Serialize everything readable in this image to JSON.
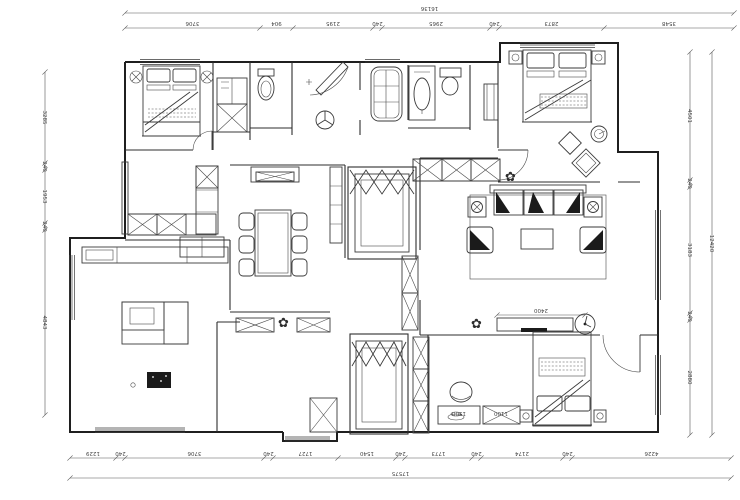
{
  "drawing": {
    "type": "residential-floor-plan",
    "units": "mm",
    "colors": {
      "line": "#1f1f1f",
      "background": "#ffffff",
      "dim_text": "#444444"
    }
  },
  "dimensions": {
    "top": {
      "total": "16136",
      "segments": [
        "3706",
        "904",
        "2195",
        "240",
        "2965",
        "240",
        "2873",
        "3548"
      ]
    },
    "bottom": {
      "total": "17575",
      "segments": [
        "1229",
        "240",
        "3706",
        "240",
        "1727",
        "1540",
        "240",
        "1773",
        "240",
        "2174",
        "240",
        "4226"
      ]
    },
    "left": {
      "segments": [
        "3285",
        "240",
        "1953",
        "240",
        "4843"
      ]
    },
    "right": {
      "total": "12420",
      "segments": [
        "4501",
        "240",
        "3183",
        "240",
        "2880"
      ]
    },
    "interior": {
      "tv_cabinet": "2400",
      "desk": "1500",
      "cabinet": "1100"
    }
  },
  "icons": {
    "plant_glyph": "✿"
  }
}
